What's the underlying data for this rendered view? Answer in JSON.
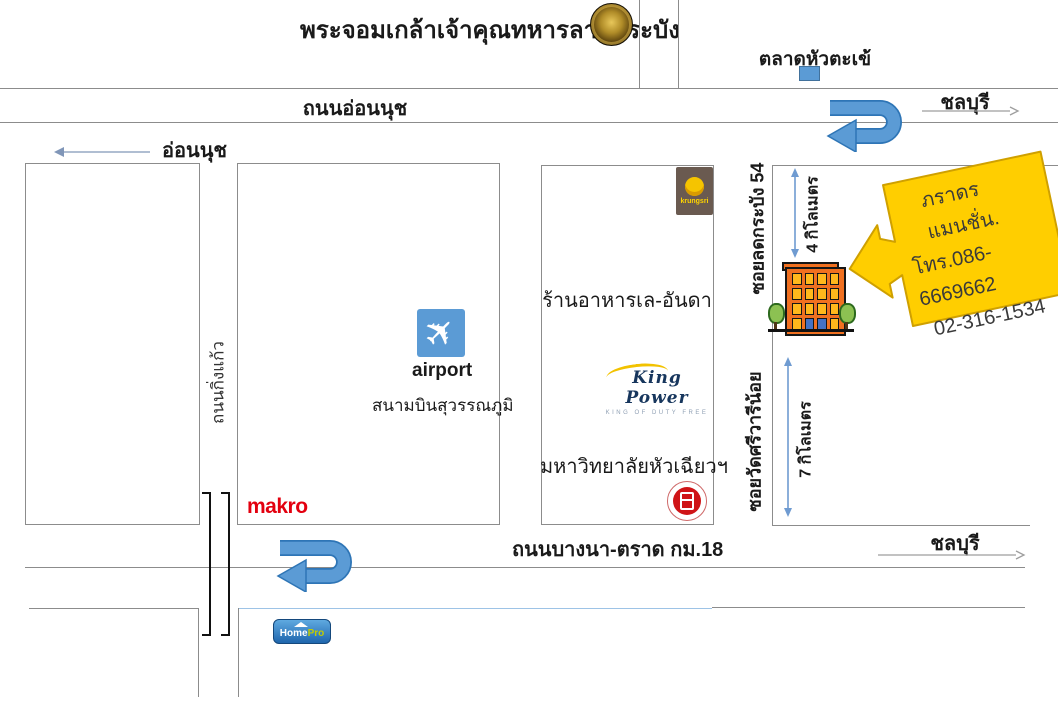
{
  "map": {
    "title": "พระจอมเกล้าเจ้าคุณทหารลาดกระบัง",
    "market": "ตลาดหัวตะเข้",
    "chonburi_top": "ชลบุรี",
    "chonburi_bottom": "ชลบุรี",
    "onnut_road": "ถนนอ่อนนุช",
    "onnut_dir": "อ่อนนุช",
    "kingkaew_road": "ถนนกิ่งแก้ว",
    "bangna_road": "ถนนบางนา-ตราด กม.18",
    "soi_54": "ซอยลดกระบัง 54",
    "soi_watsrivaree": "ซอยวัดศรีวารีน้อย",
    "km4": "4 กิโลเมตร",
    "km7": "7 กิโลเมตร",
    "airport_en": "airport",
    "airport_th": "สนามบินสุวรรณภูมิ",
    "restaurant": "ร้านอาหารเล-อันดา",
    "huachiew_university": "มหาวิทยาลัยหัวเฉียวฯ",
    "makro": "makro",
    "krungsri": "krungsri",
    "kingpower": "King Power",
    "kingpower_tagline": "KING OF DUTY FREE",
    "homepro_home": "Home",
    "homepro_pro": "Pro",
    "callout": {
      "name": "ภราดรแมนชั่น.",
      "phone1": "โทร.086-6669662",
      "phone2": "02-316-1534"
    },
    "colors": {
      "uturn_blue": "#5B9BD5",
      "uturn_blue_dark": "#2E75B6",
      "km_arrow_blue": "#6F9BD1",
      "callout_yellow": "#FFCE00",
      "callout_border": "#CFA000",
      "makro_red": "#E3000F",
      "building_orange": "#F07020",
      "road_gray": "#8C8C8C"
    }
  }
}
